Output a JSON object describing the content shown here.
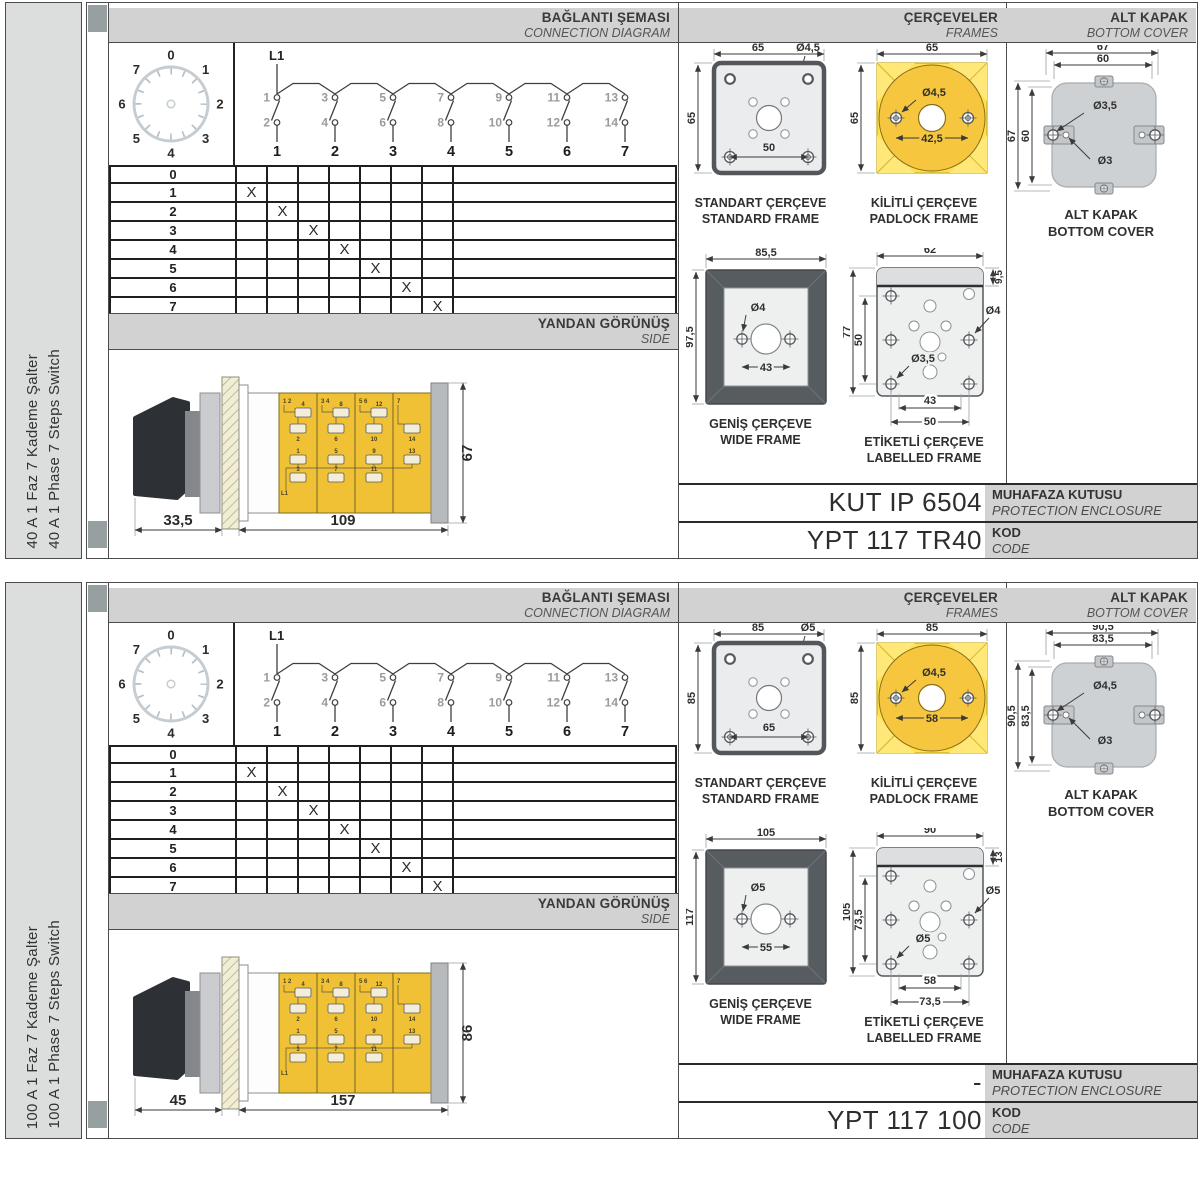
{
  "sections": [
    {
      "side_label_tr": "40 A 1 Faz 7 Kademe Şalter",
      "side_label_en": "40 A 1 Phase 7 Steps Switch",
      "connection": {
        "title_tr": "BAĞLANTI ŞEMASI",
        "title_en": "CONNECTION DIAGRAM",
        "line_label": "L1",
        "dial": [
          "0",
          "1",
          "2",
          "3",
          "4",
          "5",
          "6",
          "7"
        ],
        "odd": [
          "1",
          "3",
          "5",
          "7",
          "9",
          "11",
          "13"
        ],
        "even": [
          "2",
          "4",
          "6",
          "8",
          "10",
          "12",
          "14"
        ],
        "cols": [
          "1",
          "2",
          "3",
          "4",
          "5",
          "6",
          "7"
        ],
        "rows": [
          {
            "p": "0",
            "m": [
              "",
              "",
              "",
              "",
              "",
              "",
              ""
            ]
          },
          {
            "p": "1",
            "m": [
              "X",
              "",
              "",
              "",
              "",
              "",
              ""
            ]
          },
          {
            "p": "2",
            "m": [
              "",
              "X",
              "",
              "",
              "",
              "",
              ""
            ]
          },
          {
            "p": "3",
            "m": [
              "",
              "",
              "X",
              "",
              "",
              "",
              ""
            ]
          },
          {
            "p": "4",
            "m": [
              "",
              "",
              "",
              "X",
              "",
              "",
              ""
            ]
          },
          {
            "p": "5",
            "m": [
              "",
              "",
              "",
              "",
              "X",
              "",
              ""
            ]
          },
          {
            "p": "6",
            "m": [
              "",
              "",
              "",
              "",
              "",
              "X",
              ""
            ]
          },
          {
            "p": "7",
            "m": [
              "",
              "",
              "",
              "",
              "",
              "",
              "X"
            ]
          }
        ]
      },
      "side_view": {
        "title_tr": "YANDAN GÖRÜNÜŞ",
        "title_en": "SIDE",
        "dim_depth": "33,5",
        "dim_length": "109",
        "dim_height": "67",
        "top_labels": [
          "1 2",
          "3 4",
          "5 6",
          "7"
        ],
        "upper": [
          "4",
          "8",
          "12"
        ],
        "mid": [
          "2",
          "6",
          "10",
          "14"
        ],
        "low_a": [
          "1",
          "5",
          "9",
          "13"
        ],
        "low_b": [
          "3",
          "7",
          "11"
        ],
        "bus": "L1"
      },
      "frames": {
        "title_tr": "ÇERÇEVELER",
        "title_en": "FRAMES",
        "standard": {
          "tr": "STANDART ÇERÇEVE",
          "en": "STANDARD FRAME",
          "w": "65",
          "h": "65",
          "hole": "Ø4,5",
          "inner": "50"
        },
        "padlock": {
          "tr": "KİLİTLİ ÇERÇEVE",
          "en": "PADLOCK FRAME",
          "w": "65",
          "h": "65",
          "hole": "Ø4,5",
          "spacing": "42,5"
        },
        "wide": {
          "tr": "GENİŞ ÇERÇEVE",
          "en": "WIDE FRAME",
          "w": "85,5",
          "h": "97,5",
          "hole": "Ø4",
          "spacing": "43"
        },
        "labelled": {
          "tr": "ETİKETLİ ÇERÇEVE",
          "en": "LABELLED FRAME",
          "w": "62",
          "strip": "9,5",
          "h": "77",
          "inner": "50",
          "hole_right": "Ø4",
          "hole_left": "Ø3,5",
          "dim_inner": "43",
          "dim_outer": "50"
        }
      },
      "cover": {
        "title_tr": "ALT KAPAK",
        "title_en": "BOTTOM COVER",
        "caption_tr": "ALT KAPAK",
        "caption_en": "BOTTOM COVER",
        "w_outer": "67",
        "w_inner": "60",
        "h_outer": "67",
        "h_inner": "60",
        "hole_big": "Ø3,5",
        "hole_small": "Ø3"
      },
      "codes": {
        "enclosure_value": "KUT IP 6504",
        "enclosure_tr": "MUHAFAZA KUTUSU",
        "enclosure_en": "PROTECTION ENCLOSURE",
        "code_value": "YPT 117 TR40",
        "code_tr": "KOD",
        "code_en": "CODE"
      }
    },
    {
      "side_label_tr": "100 A 1 Faz 7 Kademe Şalter",
      "side_label_en": "100 A 1 Phase 7 Steps Switch",
      "connection": {
        "title_tr": "BAĞLANTI ŞEMASI",
        "title_en": "CONNECTION DIAGRAM",
        "line_label": "L1",
        "dial": [
          "0",
          "1",
          "2",
          "3",
          "4",
          "5",
          "6",
          "7"
        ],
        "odd": [
          "1",
          "3",
          "5",
          "7",
          "9",
          "11",
          "13"
        ],
        "even": [
          "2",
          "4",
          "6",
          "8",
          "10",
          "12",
          "14"
        ],
        "cols": [
          "1",
          "2",
          "3",
          "4",
          "5",
          "6",
          "7"
        ],
        "rows": [
          {
            "p": "0",
            "m": [
              "",
              "",
              "",
              "",
              "",
              "",
              ""
            ]
          },
          {
            "p": "1",
            "m": [
              "X",
              "",
              "",
              "",
              "",
              "",
              ""
            ]
          },
          {
            "p": "2",
            "m": [
              "",
              "X",
              "",
              "",
              "",
              "",
              ""
            ]
          },
          {
            "p": "3",
            "m": [
              "",
              "",
              "X",
              "",
              "",
              "",
              ""
            ]
          },
          {
            "p": "4",
            "m": [
              "",
              "",
              "",
              "X",
              "",
              "",
              ""
            ]
          },
          {
            "p": "5",
            "m": [
              "",
              "",
              "",
              "",
              "X",
              "",
              ""
            ]
          },
          {
            "p": "6",
            "m": [
              "",
              "",
              "",
              "",
              "",
              "X",
              ""
            ]
          },
          {
            "p": "7",
            "m": [
              "",
              "",
              "",
              "",
              "",
              "",
              "X"
            ]
          }
        ]
      },
      "side_view": {
        "title_tr": "YANDAN GÖRÜNÜŞ",
        "title_en": "SIDE",
        "dim_depth": "45",
        "dim_length": "157",
        "dim_height": "86",
        "top_labels": [
          "1 2",
          "3 4",
          "5 6",
          "7"
        ],
        "upper": [
          "4",
          "8",
          "12"
        ],
        "mid": [
          "2",
          "6",
          "10",
          "14"
        ],
        "low_a": [
          "1",
          "5",
          "9",
          "13"
        ],
        "low_b": [
          "3",
          "7",
          "11"
        ],
        "bus": "L1"
      },
      "frames": {
        "title_tr": "ÇERÇEVELER",
        "title_en": "FRAMES",
        "standard": {
          "tr": "STANDART ÇERÇEVE",
          "en": "STANDARD FRAME",
          "w": "85",
          "h": "85",
          "hole": "Ø5",
          "inner": "65"
        },
        "padlock": {
          "tr": "KİLİTLİ ÇERÇEVE",
          "en": "PADLOCK FRAME",
          "w": "85",
          "h": "85",
          "hole": "Ø4,5",
          "spacing": "58"
        },
        "wide": {
          "tr": "GENİŞ ÇERÇEVE",
          "en": "WIDE FRAME",
          "w": "105",
          "h": "117",
          "hole": "Ø5",
          "spacing": "55"
        },
        "labelled": {
          "tr": "ETİKETLİ ÇERÇEVE",
          "en": "LABELLED FRAME",
          "w": "90",
          "strip": "13",
          "h": "105",
          "inner": "73,5",
          "hole_right": "Ø5",
          "hole_left": "Ø5",
          "dim_inner": "58",
          "dim_outer": "73,5"
        }
      },
      "cover": {
        "title_tr": "ALT KAPAK",
        "title_en": "BOTTOM COVER",
        "caption_tr": "ALT KAPAK",
        "caption_en": "BOTTOM COVER",
        "w_outer": "90,5",
        "w_inner": "83,5",
        "h_outer": "90,5",
        "h_inner": "83,5",
        "hole_big": "Ø4,5",
        "hole_small": "Ø3"
      },
      "codes": {
        "enclosure_value": "-",
        "enclosure_tr": "MUHAFAZA KUTUSU",
        "enclosure_en": "PROTECTION ENCLOSURE",
        "code_value": "YPT 117 100",
        "code_tr": "KOD",
        "code_en": "CODE"
      }
    }
  ]
}
